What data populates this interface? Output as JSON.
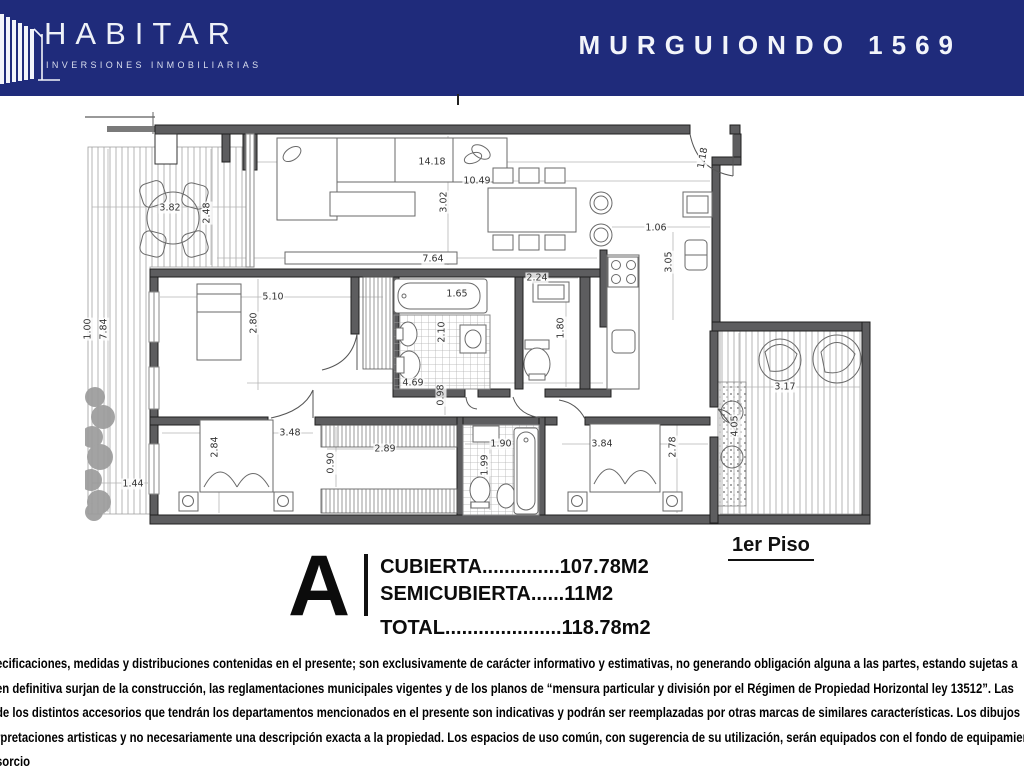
{
  "header": {
    "brand": "HABITAR",
    "brand_sub": "INVERSIONES INMOBILIARIAS",
    "title": "MURGUIONDO 1569",
    "bg_color": "#1f2b7b"
  },
  "plan": {
    "floor_label": "1er Piso",
    "unit": {
      "letter": "A",
      "lines": [
        "CUBIERTA..............107.78M2",
        "SEMICUBIERTA......11M2",
        "TOTAL.....................118.78m2"
      ]
    },
    "dimensions": [
      {
        "t": "14.18",
        "x": 347,
        "y": 50,
        "r": 0
      },
      {
        "t": "10.49",
        "x": 392,
        "y": 69,
        "r": 0
      },
      {
        "t": "3.02",
        "x": 359,
        "y": 90,
        "r": -90
      },
      {
        "t": "7.64",
        "x": 348,
        "y": 147,
        "r": 0
      },
      {
        "t": "1.18",
        "x": 618,
        "y": 46,
        "r": -80
      },
      {
        "t": "1.06",
        "x": 571,
        "y": 116,
        "r": 0
      },
      {
        "t": "3.05",
        "x": 584,
        "y": 150,
        "r": -90
      },
      {
        "t": "3.82",
        "x": 85,
        "y": 96,
        "r": 0
      },
      {
        "t": "2.48",
        "x": 122,
        "y": 101,
        "r": -90
      },
      {
        "t": "1.44",
        "x": 48,
        "y": 372,
        "r": 0
      },
      {
        "t": "7.84",
        "x": 19,
        "y": 217,
        "r": -90
      },
      {
        "t": "1.00",
        "x": 3,
        "y": 217,
        "r": -90
      },
      {
        "t": "5.10",
        "x": 188,
        "y": 185,
        "r": 0
      },
      {
        "t": "2.80",
        "x": 169,
        "y": 211,
        "r": -90
      },
      {
        "t": "1.65",
        "x": 372,
        "y": 182,
        "r": 0
      },
      {
        "t": "2.10",
        "x": 357,
        "y": 220,
        "r": -90
      },
      {
        "t": "2.24",
        "x": 452,
        "y": 166,
        "r": 0
      },
      {
        "t": "1.80",
        "x": 476,
        "y": 216,
        "r": -90
      },
      {
        "t": "4.69",
        "x": 328,
        "y": 271,
        "r": 0
      },
      {
        "t": "0.98",
        "x": 356,
        "y": 283,
        "r": -90
      },
      {
        "t": "3.48",
        "x": 205,
        "y": 321,
        "r": 0
      },
      {
        "t": "2.84",
        "x": 130,
        "y": 335,
        "r": -90
      },
      {
        "t": "2.89",
        "x": 300,
        "y": 337,
        "r": 0
      },
      {
        "t": "0.90",
        "x": 246,
        "y": 351,
        "r": -90
      },
      {
        "t": "1.90",
        "x": 416,
        "y": 332,
        "r": 0
      },
      {
        "t": "1.99",
        "x": 400,
        "y": 353,
        "r": -90
      },
      {
        "t": "3.84",
        "x": 517,
        "y": 332,
        "r": 0
      },
      {
        "t": "2.78",
        "x": 588,
        "y": 335,
        "r": -90
      },
      {
        "t": "3.17",
        "x": 700,
        "y": 275,
        "r": 0
      },
      {
        "t": "4.05",
        "x": 650,
        "y": 314,
        "r": -90
      }
    ]
  },
  "disclaimer": {
    "lines": [
      "ecificaciones, medidas y distribuciones contenidas en el presente; son exclusivamente de carácter informativo y estimativas, no generando obligación alguna a las partes, estando sujetas a",
      "en definitiva surjan de la construcción, las reglamentaciones municipales vigentes y de los planos de “mensura particular y división por el Régimen de Propiedad Horizontal ley 13512”. Las",
      "de los distintos accesorios que tendrán los departamentos mencionados en el presente son indicativas y podrán ser reemplazadas por otras marcas de similares características. Los dibujos",
      "rpretaciones artisticas y no necesariamente una descripción exacta a la propiedad. Los espacios de uso común, con sugerencia de su utilización, serán equipados con el fondo de equipamiento",
      "sorcio"
    ]
  }
}
